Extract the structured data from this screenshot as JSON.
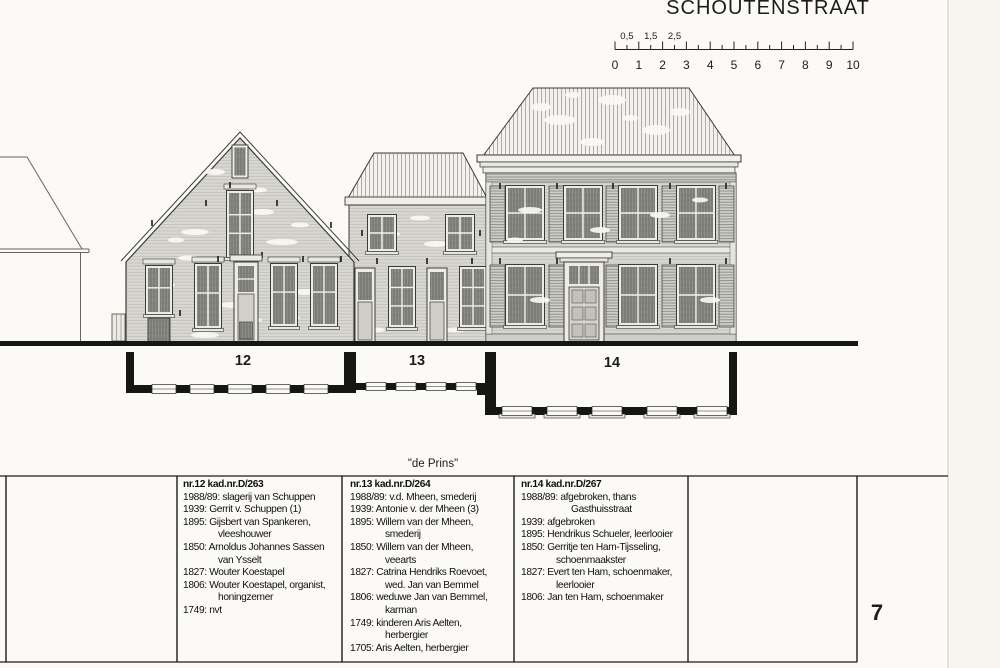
{
  "page": {
    "title": "SCHOUTENSTRAAT",
    "page_number": "7",
    "house_name": "\"de Prins\""
  },
  "scale_bar": {
    "half_labels": [
      "0,5",
      "1,5",
      "2,5"
    ],
    "unit_labels": [
      "0",
      "1",
      "2",
      "3",
      "4",
      "5",
      "6",
      "7",
      "8",
      "9",
      "10"
    ]
  },
  "buildings": [
    {
      "plan_number": "12"
    },
    {
      "plan_number": "13"
    },
    {
      "plan_number": "14"
    }
  ],
  "history_table": {
    "columns": [
      {
        "header": "nr.12 kad.nr.D/263",
        "entries": [
          {
            "lines": [
              "1988/89: slagerij van Schuppen"
            ]
          },
          {
            "lines": [
              "1939: Gerrit v. Schuppen (1)"
            ]
          },
          {
            "lines": [
              "1895: Gijsbert van Spankeren,",
              "vleeshouwer"
            ]
          },
          {
            "lines": [
              "1850: Arnoldus Johannes Sassen",
              "van Ysselt"
            ]
          },
          {
            "lines": [
              "1827: Wouter Koestapel"
            ]
          },
          {
            "lines": [
              "1806: Wouter Koestapel, organist,",
              "honingzemer"
            ]
          },
          {
            "lines": [
              "1749: nvt"
            ]
          }
        ]
      },
      {
        "header": "nr.13 kad.nr.D/264",
        "entries": [
          {
            "lines": [
              "1988/89: v.d. Mheen, smederij"
            ]
          },
          {
            "lines": [
              "1939: Antonie v. der Mheen (3)"
            ]
          },
          {
            "lines": [
              "1895: Willem van der Mheen,",
              "smederij"
            ]
          },
          {
            "lines": [
              "1850: Willem van der Mheen,",
              "veearts"
            ]
          },
          {
            "lines": [
              "1827: Catrina Hendriks Roevoet,",
              "wed. Jan van Bemmel"
            ]
          },
          {
            "lines": [
              "1806: weduwe Jan van Bemmel,",
              "karman"
            ]
          },
          {
            "lines": [
              "1749: kinderen Aris Aelten,",
              "herbergier"
            ]
          },
          {
            "lines": [
              "1705: Aris Aelten, herbergier"
            ]
          }
        ]
      },
      {
        "header": "nr.14 kad.nr.D/267",
        "entries": [
          {
            "lines": [
              "1988/89: afgebroken, thans",
              "Gasthuisstraat"
            ],
            "indent": 50
          },
          {
            "lines": [
              "1939: afgebroken"
            ]
          },
          {
            "lines": [
              "1895: Hendrikus Schueler, leerlooier"
            ]
          },
          {
            "lines": [
              "1850: Gerritje ten Ham-Tijsseling,",
              "schoenmaakster"
            ]
          },
          {
            "lines": [
              "1827: Evert ten Ham, schoenmaker,",
              "leerlooier"
            ]
          },
          {
            "lines": [
              "1806: Jan ten Ham, schoenmaker"
            ]
          }
        ]
      }
    ]
  },
  "colors": {
    "ink": "#1c1c1a",
    "facade_fill": "#d8d7d1",
    "glass_fill": "#8f8f89",
    "paper": "#fbfaf6"
  }
}
